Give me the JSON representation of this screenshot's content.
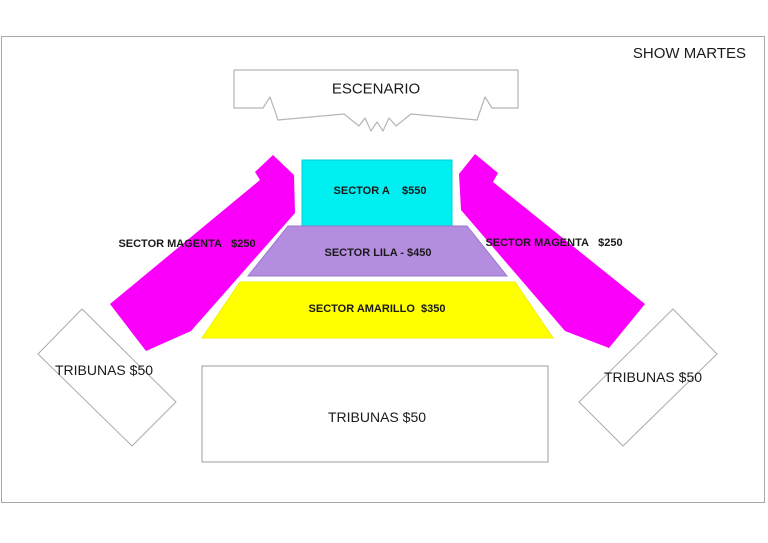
{
  "title": "SHOW MARTES",
  "stage": {
    "label": "ESCENARIO"
  },
  "sectors": {
    "a": {
      "label": "SECTOR A    $550",
      "name": "SECTOR A",
      "price": "$550",
      "color": "#00F0F2",
      "edge": "#00cfd6"
    },
    "lila": {
      "label": "SECTOR LILA - $450",
      "name": "SECTOR LILA",
      "price": "$450",
      "color": "#B48CE0",
      "edge": "#9a78c9"
    },
    "amarillo": {
      "label": "SECTOR AMARILLO  $350",
      "name": "SECTOR AMARILLO",
      "price": "$350",
      "color": "#FFFF00",
      "edge": "#f0f000"
    },
    "magenta_left": {
      "label": "SECTOR MAGENTA   $250",
      "name": "SECTOR MAGENTA",
      "price": "$250",
      "color": "#FA00FA"
    },
    "magenta_right": {
      "label": "SECTOR MAGENTA   $250",
      "name": "SECTOR MAGENTA",
      "price": "$250",
      "color": "#FA00FA"
    }
  },
  "tribunas": {
    "left": {
      "label": "TRIBUNAS $50"
    },
    "right": {
      "label": "TRIBUNAS $50"
    },
    "bottom": {
      "label": "TRIBUNAS $50"
    }
  },
  "colors": {
    "background": "#ffffff",
    "outline_gray": "#a8a8a8",
    "stage_outline": "#b6b6b6",
    "text": "#1a1a1a"
  }
}
